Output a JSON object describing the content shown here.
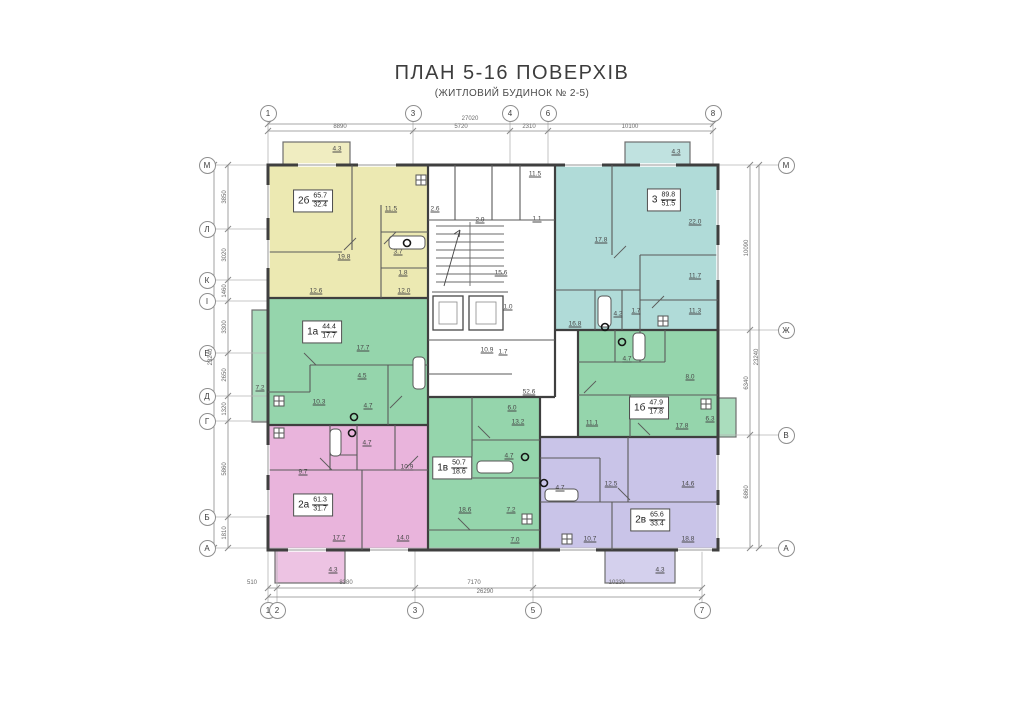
{
  "title": {
    "main": "ПЛАН 5-16 ПОВЕРХІВ",
    "sub": "(ЖИТЛОВИЙ БУДИНОК № 2-5)"
  },
  "colors": {
    "wall": "#3f3f3f",
    "line": "#8a8a8a",
    "yellow": "#ece9b2",
    "teal": "#b0dbd8",
    "green": "#95d5ac",
    "pink": "#e9b4dc",
    "purple": "#c9c4e8"
  },
  "apartments": [
    {
      "name": "2б",
      "area_total": "65.7",
      "area_living": "32.4",
      "color": "#ece9b2",
      "box": {
        "x": 313,
        "y": 201
      },
      "rooms": [
        {
          "v": "4.3",
          "x": 337,
          "y": 149
        },
        {
          "v": "11.5",
          "x": 391,
          "y": 209
        },
        {
          "v": "19.8",
          "x": 344,
          "y": 257
        },
        {
          "v": "3.7",
          "x": 398,
          "y": 252
        },
        {
          "v": "1.8",
          "x": 403,
          "y": 273
        },
        {
          "v": "12.6",
          "x": 316,
          "y": 291
        },
        {
          "v": "12.0",
          "x": 404,
          "y": 291
        }
      ]
    },
    {
      "name": "3",
      "area_total": "89.8",
      "area_living": "51.5",
      "color": "#b0dbd8",
      "box": {
        "x": 664,
        "y": 200
      },
      "rooms": [
        {
          "v": "4.3",
          "x": 676,
          "y": 152
        },
        {
          "v": "22.0",
          "x": 695,
          "y": 222
        },
        {
          "v": "17.8",
          "x": 601,
          "y": 240
        },
        {
          "v": "11.7",
          "x": 695,
          "y": 276
        },
        {
          "v": "11.3",
          "x": 695,
          "y": 311
        },
        {
          "v": "16.8",
          "x": 575,
          "y": 324
        },
        {
          "v": "4.2",
          "x": 618,
          "y": 314
        },
        {
          "v": "1.7",
          "x": 636,
          "y": 311
        }
      ]
    },
    {
      "name": "1а",
      "area_total": "44.4",
      "area_living": "17.7",
      "color": "#95d5ac",
      "box": {
        "x": 322,
        "y": 332
      },
      "rooms": [
        {
          "v": "17.7",
          "x": 363,
          "y": 348
        },
        {
          "v": "4.5",
          "x": 362,
          "y": 376
        },
        {
          "v": "10.3",
          "x": 319,
          "y": 402
        },
        {
          "v": "4.7",
          "x": 368,
          "y": 406
        },
        {
          "v": "7.2",
          "x": 260,
          "y": 388
        }
      ]
    },
    {
      "name": "1б",
      "area_total": "47.9",
      "area_living": "17.8",
      "color": "#95d5ac",
      "box": {
        "x": 649,
        "y": 408
      },
      "rooms": [
        {
          "v": "8.0",
          "x": 690,
          "y": 377
        },
        {
          "v": "4.7",
          "x": 627,
          "y": 359
        },
        {
          "v": "11.1",
          "x": 592,
          "y": 423
        },
        {
          "v": "17.8",
          "x": 682,
          "y": 426
        },
        {
          "v": "6.3",
          "x": 710,
          "y": 419
        }
      ]
    },
    {
      "name": "1в",
      "area_total": "50.7",
      "area_living": "18.6",
      "color": "#95d5ac",
      "box": {
        "x": 452,
        "y": 468
      },
      "rooms": [
        {
          "v": "6.0",
          "x": 512,
          "y": 408
        },
        {
          "v": "13.2",
          "x": 518,
          "y": 422
        },
        {
          "v": "4.7",
          "x": 509,
          "y": 456
        },
        {
          "v": "18.6",
          "x": 465,
          "y": 510
        },
        {
          "v": "7.2",
          "x": 511,
          "y": 510
        },
        {
          "v": "7.0",
          "x": 515,
          "y": 540
        }
      ]
    },
    {
      "name": "2а",
      "area_total": "61.3",
      "area_living": "31.7",
      "color": "#e9b4dc",
      "box": {
        "x": 313,
        "y": 505
      },
      "rooms": [
        {
          "v": "9.7",
          "x": 303,
          "y": 472
        },
        {
          "v": "4.7",
          "x": 367,
          "y": 443
        },
        {
          "v": "10.9",
          "x": 407,
          "y": 467
        },
        {
          "v": "17.7",
          "x": 339,
          "y": 538
        },
        {
          "v": "14.0",
          "x": 403,
          "y": 538
        },
        {
          "v": "4.3",
          "x": 333,
          "y": 570
        }
      ]
    },
    {
      "name": "2в",
      "area_total": "65.6",
      "area_living": "33.4",
      "color": "#c9c4e8",
      "box": {
        "x": 650,
        "y": 520
      },
      "rooms": [
        {
          "v": "12.5",
          "x": 611,
          "y": 484
        },
        {
          "v": "14.6",
          "x": 688,
          "y": 484
        },
        {
          "v": "4.7",
          "x": 560,
          "y": 488
        },
        {
          "v": "10.7",
          "x": 590,
          "y": 539
        },
        {
          "v": "18.8",
          "x": 688,
          "y": 539
        },
        {
          "v": "4.3",
          "x": 660,
          "y": 570
        }
      ]
    }
  ],
  "common_rooms": [
    {
      "v": "11.5",
      "x": 535,
      "y": 174
    },
    {
      "v": "2.6",
      "x": 435,
      "y": 209
    },
    {
      "v": "2.9",
      "x": 480,
      "y": 220
    },
    {
      "v": "1.1",
      "x": 537,
      "y": 219
    },
    {
      "v": "15.6",
      "x": 501,
      "y": 273
    },
    {
      "v": "1.0",
      "x": 508,
      "y": 307
    },
    {
      "v": "10.9",
      "x": 487,
      "y": 350
    },
    {
      "v": "1.7",
      "x": 503,
      "y": 352
    },
    {
      "v": "52.6",
      "x": 529,
      "y": 392
    }
  ],
  "axis_markers": [
    {
      "n": "1",
      "x": 268,
      "y": 113
    },
    {
      "n": "3",
      "x": 413,
      "y": 113
    },
    {
      "n": "4",
      "x": 510,
      "y": 113
    },
    {
      "n": "6",
      "x": 548,
      "y": 113
    },
    {
      "n": "8",
      "x": 713,
      "y": 113
    },
    {
      "n": "1",
      "x": 268,
      "y": 610
    },
    {
      "n": "2",
      "x": 277,
      "y": 610
    },
    {
      "n": "3",
      "x": 415,
      "y": 610
    },
    {
      "n": "5",
      "x": 533,
      "y": 610
    },
    {
      "n": "7",
      "x": 702,
      "y": 610
    },
    {
      "n": "М",
      "x": 207,
      "y": 165
    },
    {
      "n": "Л",
      "x": 207,
      "y": 229
    },
    {
      "n": "К",
      "x": 207,
      "y": 280
    },
    {
      "n": "І",
      "x": 207,
      "y": 301
    },
    {
      "n": "Е",
      "x": 207,
      "y": 353
    },
    {
      "n": "Д",
      "x": 207,
      "y": 396
    },
    {
      "n": "Г",
      "x": 207,
      "y": 421
    },
    {
      "n": "Б",
      "x": 207,
      "y": 517
    },
    {
      "n": "А",
      "x": 207,
      "y": 548
    },
    {
      "n": "М",
      "x": 786,
      "y": 165
    },
    {
      "n": "Ж",
      "x": 786,
      "y": 330
    },
    {
      "n": "В",
      "x": 786,
      "y": 435
    },
    {
      "n": "А",
      "x": 786,
      "y": 548
    }
  ],
  "dim_labels": [
    {
      "v": "27020",
      "x": 470,
      "y": 122
    },
    {
      "v": "8890",
      "x": 340,
      "y": 130
    },
    {
      "v": "5720",
      "x": 461,
      "y": 130
    },
    {
      "v": "2310",
      "x": 529,
      "y": 130
    },
    {
      "v": "10100",
      "x": 630,
      "y": 130
    },
    {
      "v": "510",
      "x": 252,
      "y": 586
    },
    {
      "v": "8380",
      "x": 346,
      "y": 586
    },
    {
      "v": "7170",
      "x": 474,
      "y": 586
    },
    {
      "v": "10230",
      "x": 617,
      "y": 586
    },
    {
      "v": "26290",
      "x": 485,
      "y": 595
    },
    {
      "v": "23240",
      "x": 211,
      "y": 357,
      "vert": true
    },
    {
      "v": "3850",
      "x": 225,
      "y": 197,
      "vert": true
    },
    {
      "v": "3020",
      "x": 225,
      "y": 255,
      "vert": true
    },
    {
      "v": "1460",
      "x": 225,
      "y": 291,
      "vert": true
    },
    {
      "v": "3300",
      "x": 225,
      "y": 327,
      "vert": true
    },
    {
      "v": "2650",
      "x": 225,
      "y": 375,
      "vert": true
    },
    {
      "v": "1320",
      "x": 225,
      "y": 409,
      "vert": true
    },
    {
      "v": "5860",
      "x": 225,
      "y": 469,
      "vert": true
    },
    {
      "v": "1810",
      "x": 225,
      "y": 533,
      "vert": true
    },
    {
      "v": "23240",
      "x": 757,
      "y": 357,
      "vert": true
    },
    {
      "v": "10090",
      "x": 747,
      "y": 248,
      "vert": true
    },
    {
      "v": "6340",
      "x": 747,
      "y": 383,
      "vert": true
    },
    {
      "v": "6860",
      "x": 747,
      "y": 492,
      "vert": true
    }
  ]
}
